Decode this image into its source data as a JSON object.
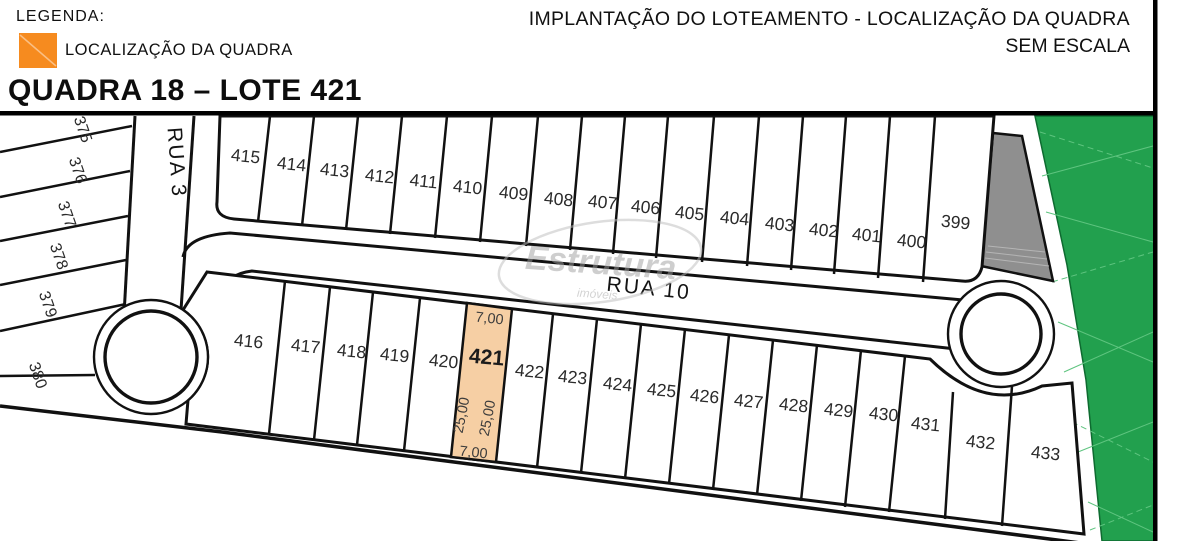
{
  "legend": {
    "title": "LEGENDA:",
    "swatch_label": "LOCALIZAÇÃO DA QUADRA",
    "swatch_color": "#F68B1F"
  },
  "header": {
    "title_line1": "IMPLANTAÇÃO DO LOTEAMENTO - LOCALIZAÇÃO DA QUADRA",
    "title_line2": "SEM ESCALA",
    "subtitle": "QUADRA 18 – LOTE 421"
  },
  "map": {
    "streets": {
      "vertical": "RUA 3",
      "horizontal": "RUA 10"
    },
    "left_column_lots": [
      "375",
      "376",
      "377",
      "378",
      "379",
      "380"
    ],
    "top_row_lots": [
      "415",
      "414",
      "413",
      "412",
      "411",
      "410",
      "409",
      "408",
      "407",
      "406",
      "405",
      "404",
      "403",
      "402",
      "401",
      "400",
      "399"
    ],
    "middle_row_lots": [
      "416",
      "417",
      "418",
      "419",
      "420",
      "422",
      "423",
      "424",
      "425",
      "426",
      "427",
      "428",
      "429",
      "430",
      "431",
      "432",
      "433"
    ],
    "highlighted_lot": {
      "number": "421",
      "fill": "#F6CFA4",
      "top_width": "7,00",
      "bottom_width": "7,00",
      "left_depth": "25,00",
      "right_depth": "25,00"
    },
    "colors": {
      "green_area": "#22A04E",
      "gray_area": "#8F8F8F",
      "highlight": "#F6CFA4"
    },
    "watermark": {
      "line1": "Estrutura",
      "line2": "imóveis"
    }
  }
}
